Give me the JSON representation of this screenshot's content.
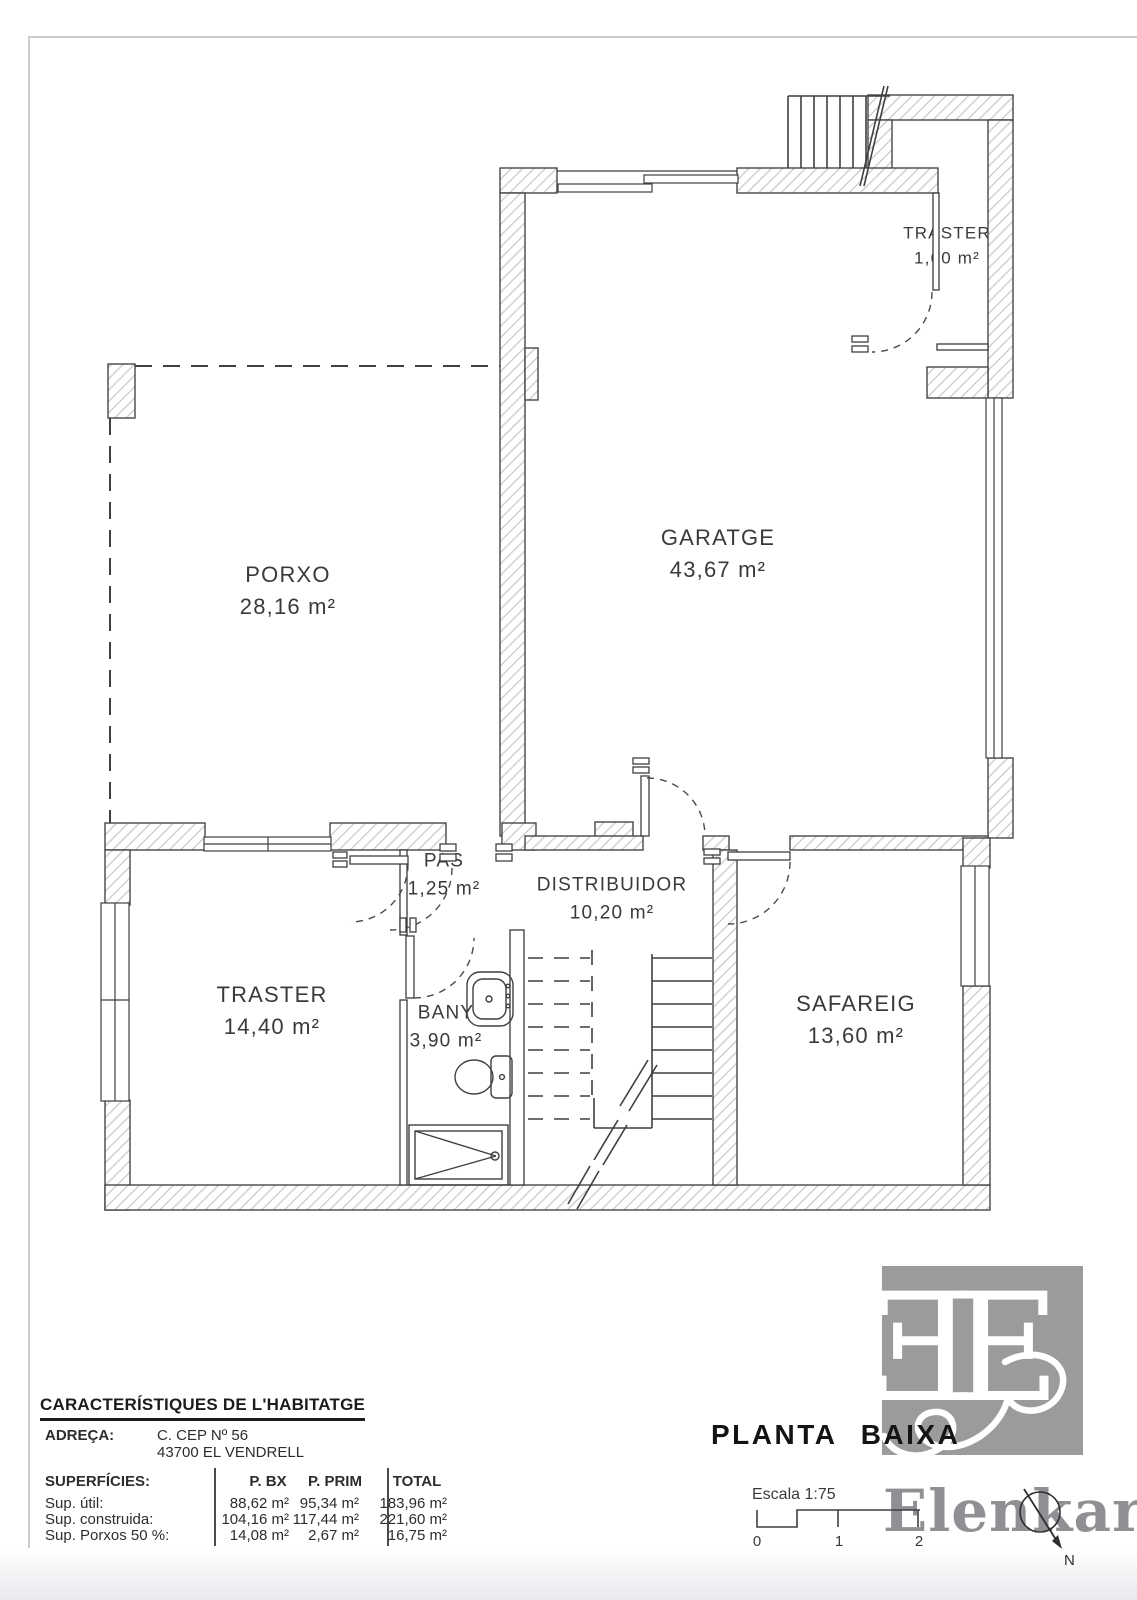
{
  "rooms": {
    "traster_top": {
      "name": "TRASTER",
      "area": "1,60 m²"
    },
    "garatge": {
      "name": "GARATGE",
      "area": "43,67 m²"
    },
    "porxo": {
      "name": "PORXO",
      "area": "28,16 m²"
    },
    "pas": {
      "name": "PAS",
      "area": "1,25 m²"
    },
    "distribuidor": {
      "name": "DISTRIBUIDOR",
      "area": "10,20 m²"
    },
    "traster_baix": {
      "name": "TRASTER",
      "area": "14,40 m²"
    },
    "bany": {
      "name": "BANY",
      "area": "3,90 m²"
    },
    "safareig": {
      "name": "SAFAREIG",
      "area": "13,60 m²"
    }
  },
  "characteristics": {
    "title": "CARACTERÍSTIQUES DE L'HABITATGE",
    "address_label": "ADREÇA:",
    "address_line1": "C.  CEP  Nº 56",
    "address_line2": "43700  EL  VENDRELL",
    "surfaces_label": "SUPERFÍCIES:",
    "col_pbx": "P. BX",
    "col_pprim": "P. PRIM",
    "col_total": "TOTAL",
    "rows": [
      {
        "label": "Sup. útil:",
        "pbx": "88,62 m²",
        "pprim": "95,34 m²",
        "total": "183,96 m²"
      },
      {
        "label": "Sup. construida:",
        "pbx": "104,16 m²",
        "pprim": "117,44 m²",
        "total": "221,60 m²"
      },
      {
        "label": "Sup. Porxos 50 %:",
        "pbx": "14,08 m²",
        "pprim": "2,67 m²",
        "total": "16,75 m²"
      }
    ]
  },
  "titleblock": {
    "plan_title": "PLANTA BAIXA",
    "scale_label": "Escala 1:75",
    "tick0": "0",
    "tick1": "1",
    "tick2": "2",
    "north_label": "N",
    "brand": "Elenkar",
    "monogram": "E"
  },
  "colors": {
    "line": "#3f3f42",
    "hatch": "#c9cbce",
    "logo_gray": "#9b9b9e",
    "watermark_gray": "#8f9094"
  }
}
